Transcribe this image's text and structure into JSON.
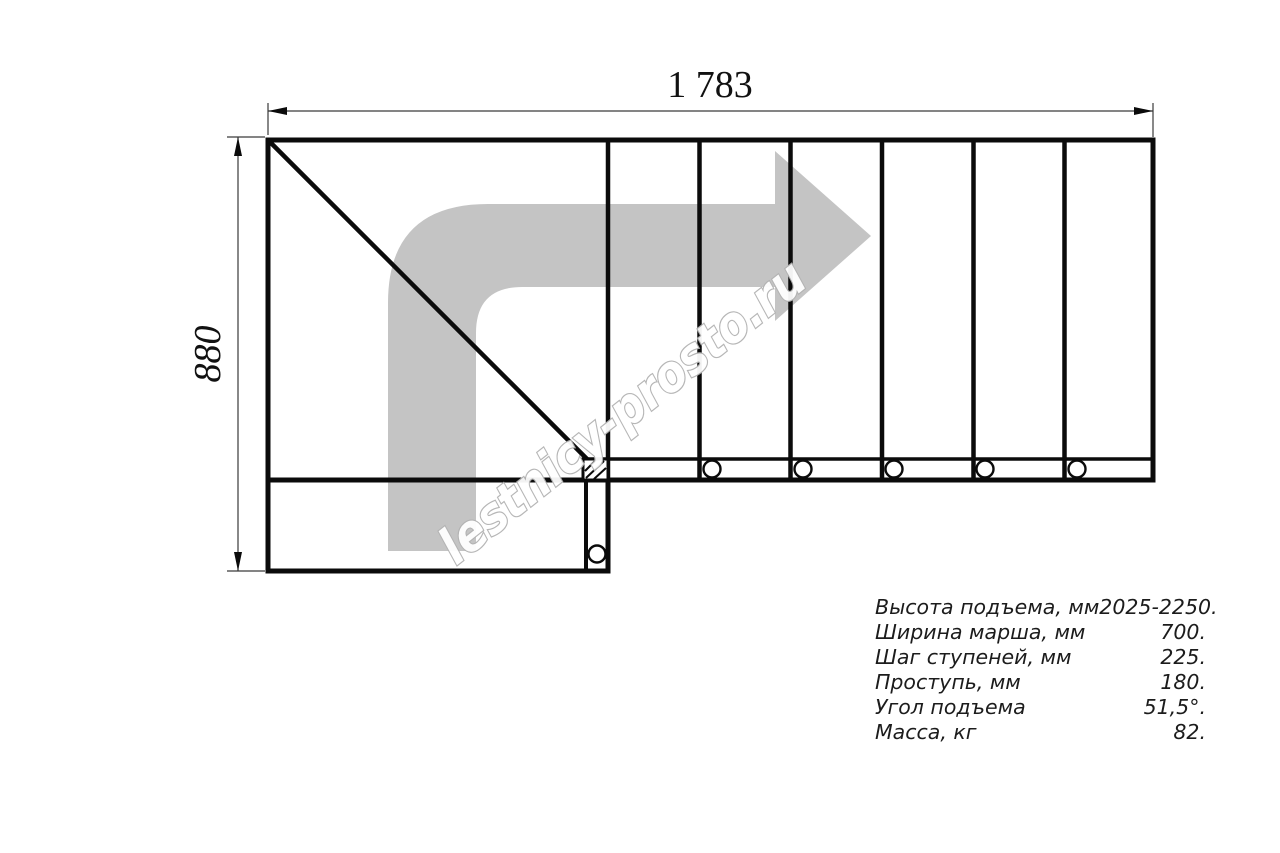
{
  "drawing": {
    "type": "staircase-plan-top-view",
    "dim_width": "1 783",
    "dim_height": "880",
    "watermark": "lestnicy-prosto.ru",
    "colors": {
      "line": "#0b0b0b",
      "arrow_fill": "#c4c4c4",
      "watermark_stroke": "#b3b3b3",
      "dim_line": "#3a3a3a"
    },
    "specs": [
      {
        "label": "Высота подъема, мм",
        "value": "2025-2250."
      },
      {
        "label": "Ширина марша, мм",
        "value": "700."
      },
      {
        "label": "Шаг ступеней, мм",
        "value": "225."
      },
      {
        "label": "Проступь, мм",
        "value": "180."
      },
      {
        "label": "Угол подъема",
        "value": "51,5°."
      },
      {
        "label": "Масса, кг",
        "value": "82."
      }
    ]
  }
}
